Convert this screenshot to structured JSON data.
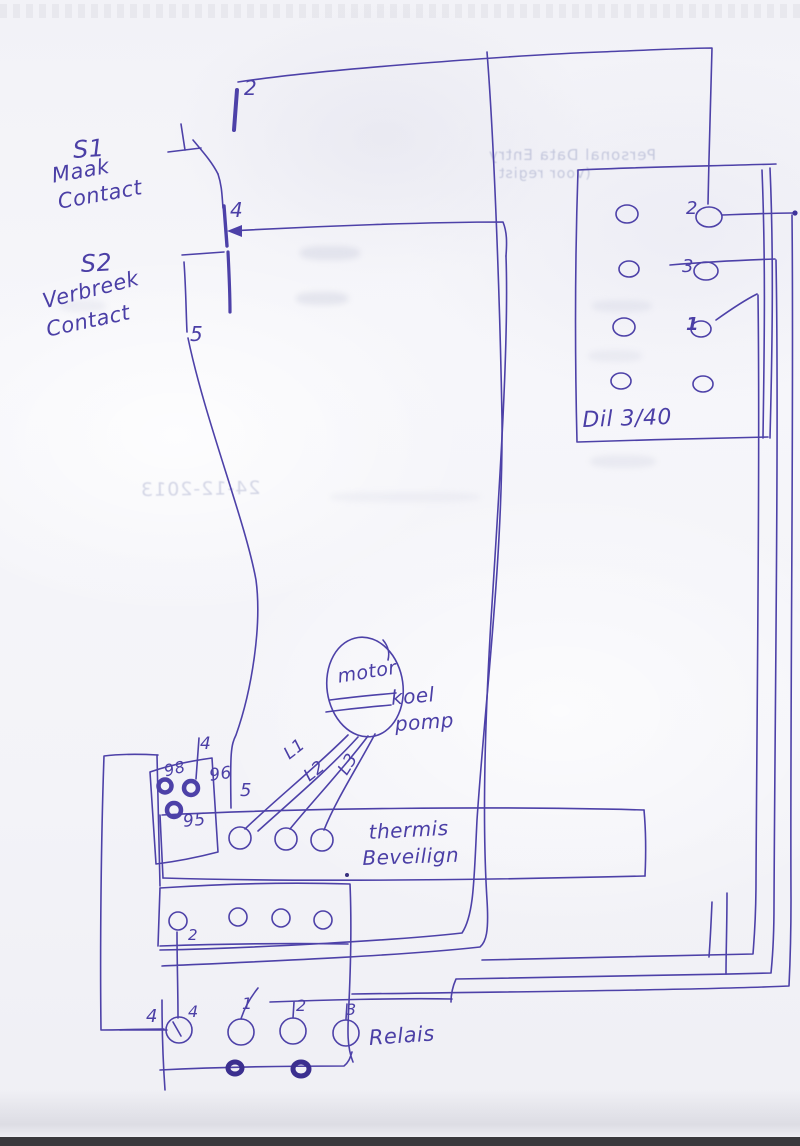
{
  "sketch": {
    "ink_color": "#4d41a8",
    "switches": {
      "node2": "2",
      "s1_name": "S1",
      "s1_line1": "Maak",
      "s1_line2": "Contact",
      "node4": "4",
      "s2_name": "S2",
      "s2_line1": "Verbreek",
      "s2_line2": "Contact",
      "node5": "5"
    },
    "contactor": {
      "terminal2": "2",
      "terminal3": "3",
      "terminal1": "1",
      "model_label": "Dil 3/40"
    },
    "motor": {
      "name": "motor",
      "caption_line1": "koel",
      "caption_line2": "pomp"
    },
    "phases": {
      "l1": "L1",
      "l2": "L2",
      "l3": "L3"
    },
    "overload": {
      "t98": "98",
      "t96": "96",
      "t95": "95",
      "wire4": "4",
      "wire5": "5",
      "caption_line1": "thermis",
      "caption_line2": "Beveilign"
    },
    "aux_block": {
      "t2": "2"
    },
    "relay": {
      "outer4": "4",
      "t4": "4",
      "t1": "1",
      "t2": "2",
      "t3": "3",
      "label": "Relais"
    },
    "bleedthrough": {
      "line1": "Personal Data Entry",
      "line2": "(voor regist",
      "date": "24-12-2013"
    }
  }
}
